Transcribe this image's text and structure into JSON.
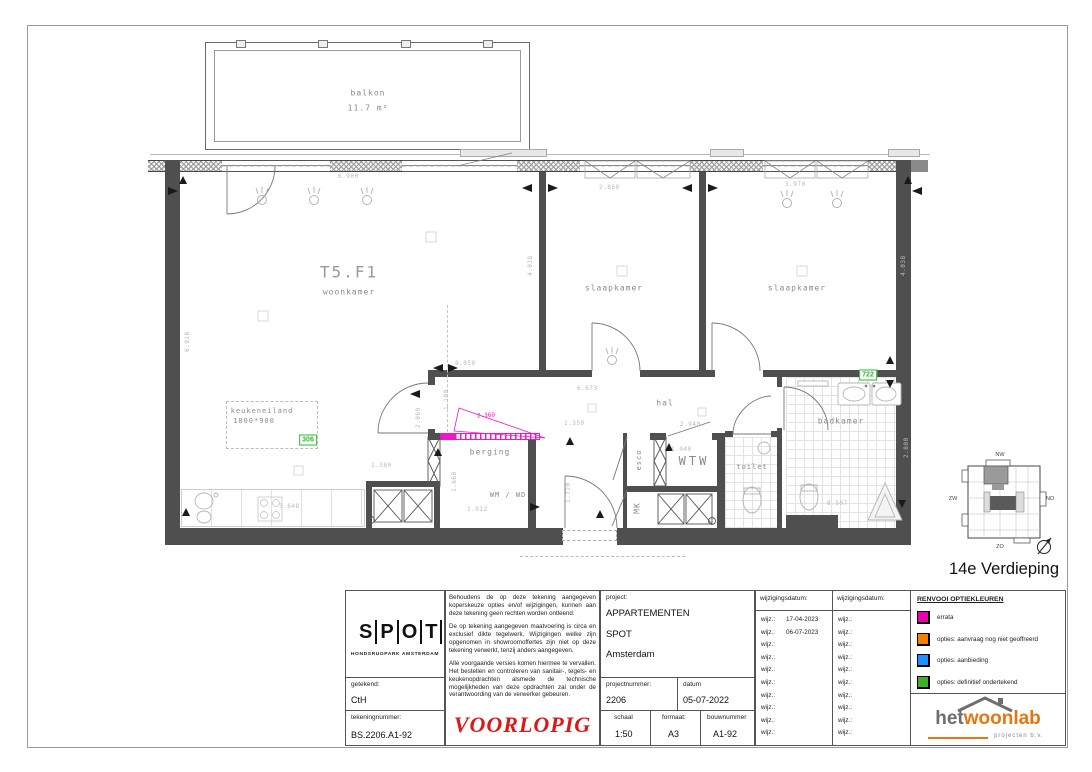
{
  "sheet": {
    "floor_title": "14e Verdieping"
  },
  "plan": {
    "balcony": {
      "label": "balkon",
      "area": "11.7 m²"
    },
    "rooms": {
      "unit_code": "T5.F1",
      "living": "woonkamer",
      "bedroom1": "slaapkamer",
      "bedroom2": "slaapkamer",
      "hall": "hal",
      "storage": "berging",
      "wmwd": "WM / WD",
      "wtw": "WTW",
      "toilet": "toilet",
      "bathroom": "badkamer",
      "esco": "esco",
      "mk": "MK"
    },
    "kitchen_island": {
      "label": "keukeneiland",
      "size": "1800*900"
    },
    "tags": {
      "kitchen_island": "306",
      "bathroom": "722"
    },
    "errata_dim": "2.360",
    "dims": [
      {
        "t": "6.900",
        "x": 338,
        "y": 173
      },
      {
        "t": "2.860",
        "x": 599,
        "y": 184
      },
      {
        "t": "3.970",
        "x": 785,
        "y": 181
      },
      {
        "t": "8.050",
        "x": 455,
        "y": 360
      },
      {
        "t": "6.673",
        "x": 577,
        "y": 385
      },
      {
        "t": "1.350",
        "x": 564,
        "y": 420
      },
      {
        "t": "2.940",
        "x": 680,
        "y": 421
      },
      {
        "t": "1.040",
        "x": 671,
        "y": 446
      },
      {
        "t": "3.648",
        "x": 279,
        "y": 503
      },
      {
        "t": "1.012",
        "x": 467,
        "y": 506
      },
      {
        "t": "1.380",
        "x": 371,
        "y": 462
      },
      {
        "t": "8.507",
        "x": 827,
        "y": 500
      },
      {
        "t": "6.918",
        "x": 184,
        "y": 352,
        "v": true
      },
      {
        "t": "4.038",
        "x": 527,
        "y": 276,
        "v": true
      },
      {
        "t": "4.038",
        "x": 900,
        "y": 276,
        "v": true
      },
      {
        "t": "1.100",
        "x": 443,
        "y": 410,
        "v": true
      },
      {
        "t": "2.060",
        "x": 415,
        "y": 428,
        "v": true
      },
      {
        "t": "1.660",
        "x": 451,
        "y": 492,
        "v": true
      },
      {
        "t": "1.720",
        "x": 565,
        "y": 503,
        "v": true
      },
      {
        "t": "2.800",
        "x": 903,
        "y": 458,
        "v": true
      }
    ],
    "locator": {
      "nw": "NW",
      "zw": "ZW",
      "no": "NO",
      "zo": "ZO"
    }
  },
  "titleblock": {
    "logo": {
      "letters": [
        "S",
        "P",
        "O",
        "T"
      ],
      "subtitle": "HONDSRUGPARK AMSTERDAM"
    },
    "getekend_label": "getekend:",
    "getekend": "CtH",
    "tekeningnummer_label": "tekeningnummer:",
    "tekeningnummer": "BS.2206.A1-92",
    "disclaimer1": "Behoudens de op deze tekening aangegeven koperskeuze opties en/of wijzigingen, kunnen aan deze tekening geen rechten worden ontleend.",
    "disclaimer2": "De op tekening aangegeven maatvoering is circa en exclusief dikte tegelwerk. Wijzigingen welke zijn opgenomen in showroomoffertes zijn niet op deze tekening verwerkt, tenzij anders aangegeven.",
    "disclaimer3": "Alle voorgaande versies komen hiermee te vervallen. Het bestellen en controleren van sanitair-, tegels- en keukenopdrachten alsmede de technische mogelijkheden van deze opdrachten zal onder de verantwoording van de verwerker gebeuren.",
    "voorlopig": "VOORLOPIG",
    "project_label": "project:",
    "project_lines": [
      "APPARTEMENTEN",
      "SPOT",
      "Amsterdam"
    ],
    "projectnummer_label": "projectnummer:",
    "projectnummer": "2206",
    "datum_label": "datum",
    "datum": "05-07-2022",
    "schaal_label": "schaal",
    "schaal": "1:50",
    "formaat_label": "formaat:",
    "formaat": "A3",
    "bouwnummer_label": "bouwnummer",
    "bouwnummer": "A1-92",
    "wijz_header": "wijzigingsdatum:",
    "wijz_label": "wijz.:",
    "wijz_rows": 10,
    "wijz_col1_dates": [
      "17-04-2023",
      "06-07-2023"
    ],
    "legend": {
      "header": "RENVOOI OPTIEKLEUREN",
      "items": [
        {
          "color": "#ee00aa",
          "label": "errata"
        },
        {
          "color": "#f57f00",
          "label": "opties: aanvraag nog niet geoffreerd"
        },
        {
          "color": "#1f8fff",
          "label": "opties: aanbieding"
        },
        {
          "color": "#3fae2a",
          "label": "opties: definitief ondertekend"
        }
      ]
    },
    "brand": {
      "het": "het",
      "woonlab": "woonlab",
      "sub": "projecten b.v."
    }
  }
}
